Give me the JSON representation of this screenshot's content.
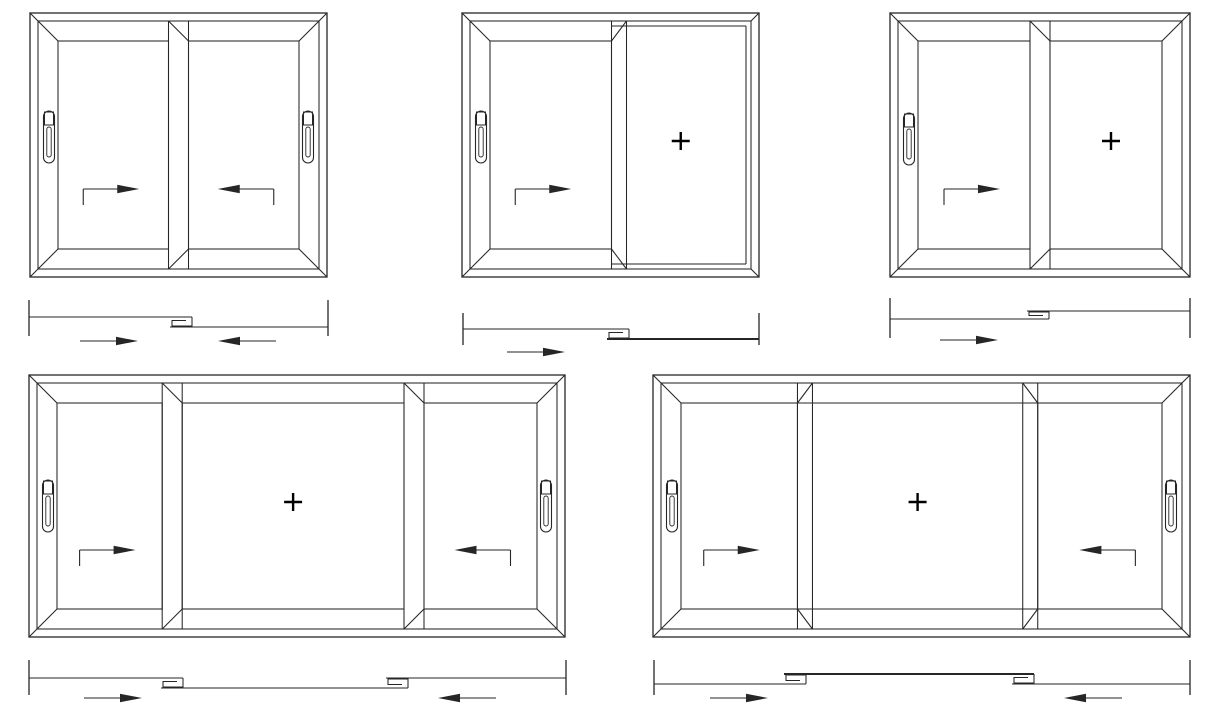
{
  "title": "Sliding window type diagrams",
  "style": {
    "background": "#ffffff",
    "line_color": "#262626",
    "plus_mark_color": "#000000",
    "thin_stroke": 1.05,
    "frame_stroke": 1.3,
    "thick_stroke": 2
  },
  "canvas": {
    "width": 1214,
    "height": 711
  },
  "windows": [
    {
      "id": "window-1",
      "kind": "two-panel-both-sliding",
      "x": 30,
      "y": 13,
      "w": 297,
      "h": 264,
      "handle_dy": -8,
      "panels": [
        {
          "type": "slider",
          "frac": 0.5,
          "handle": "left",
          "arrow": "right"
        },
        {
          "type": "slider",
          "frac": 0.5,
          "handle": "right",
          "arrow": "left"
        }
      ]
    },
    {
      "id": "window-2",
      "kind": "left-sliding-right-fixed",
      "x": 462,
      "y": 13,
      "w": 297,
      "h": 264,
      "handle_dy": -8,
      "panels": [
        {
          "type": "slider",
          "frac": 0.5,
          "handle": "left",
          "arrow": "right"
        },
        {
          "type": "fixed",
          "frac": 0.5,
          "plus": true,
          "glass_inset": 5
        }
      ]
    },
    {
      "id": "window-3",
      "kind": "left-sliding-right-fixed-leaf",
      "x": 890,
      "y": 13,
      "w": 300,
      "h": 264,
      "handle_dy": -6,
      "panels": [
        {
          "type": "slider",
          "frac": 0.5,
          "handle": "left",
          "arrow": "right"
        },
        {
          "type": "slider",
          "frac": 0.5,
          "plus": true
        }
      ]
    },
    {
      "id": "window-4",
      "kind": "three-panel-sliders-fixed-center-leaf",
      "x": 29,
      "y": 375,
      "w": 536,
      "h": 262,
      "handle_dy": 0,
      "panels": [
        {
          "type": "slider",
          "frac": 0.26,
          "handle": "left",
          "arrow": "right"
        },
        {
          "type": "slider",
          "frac": 0.465,
          "plus": true
        },
        {
          "type": "slider",
          "frac": 0.275,
          "handle": "right",
          "arrow": "left"
        }
      ]
    },
    {
      "id": "window-5",
      "kind": "three-panel-sliders-fixed-center-pane",
      "x": 653,
      "y": 375,
      "w": 537,
      "h": 262,
      "handle_dy": 0,
      "panels": [
        {
          "type": "slider",
          "frac": 0.26,
          "handle": "left",
          "arrow": "right"
        },
        {
          "type": "fixed",
          "frac": 0.465,
          "plus": true,
          "glass_inset": 20
        },
        {
          "type": "slider",
          "frac": 0.275,
          "handle": "right",
          "arrow": "left"
        }
      ]
    }
  ],
  "plans": [
    {
      "id": "plan-1",
      "x0": 29,
      "x1": 328,
      "tick_top": 300,
      "tick_bottom": 336,
      "y_upper": 317,
      "y_lower": 327,
      "arrow_y": 341,
      "hooks": [
        {
          "x": 183,
          "type": "A"
        }
      ],
      "arrows": [
        {
          "cx": 106,
          "dir": "right"
        },
        {
          "cx": 250,
          "dir": "left"
        }
      ],
      "thick": []
    },
    {
      "id": "plan-2",
      "x0": 463,
      "x1": 759,
      "tick_top": 313,
      "tick_bottom": 345,
      "y_upper": 329,
      "y_lower": 339,
      "arrow_y": 352,
      "hooks": [
        {
          "x": 620,
          "type": "A"
        }
      ],
      "arrows": [
        {
          "cx": 533,
          "dir": "right"
        }
      ],
      "thick": [
        1
      ]
    },
    {
      "id": "plan-3",
      "x0": 890,
      "x1": 1190,
      "tick_top": 298,
      "tick_bottom": 338,
      "y_upper": 311,
      "y_lower": 319,
      "arrow_y": 340,
      "hooks": [
        {
          "x": 1040,
          "type": "B"
        }
      ],
      "arrows": [
        {
          "cx": 966,
          "dir": "right"
        }
      ],
      "thick": []
    },
    {
      "id": "plan-4",
      "x0": 29,
      "x1": 566,
      "tick_top": 660,
      "tick_bottom": 695,
      "y_upper": 678,
      "y_lower": 688,
      "arrow_y": 698,
      "hooks": [
        {
          "x": 174,
          "type": "A"
        },
        {
          "x": 399,
          "type": "B"
        }
      ],
      "arrows": [
        {
          "cx": 110,
          "dir": "right"
        },
        {
          "cx": 470,
          "dir": "left"
        }
      ],
      "thick": []
    },
    {
      "id": "plan-5",
      "x0": 654,
      "x1": 1190,
      "tick_top": 660,
      "tick_bottom": 695,
      "y_upper": 674,
      "y_lower": 684,
      "arrow_y": 698,
      "hooks": [
        {
          "x": 797,
          "type": "B"
        },
        {
          "x": 1025,
          "type": "A"
        }
      ],
      "arrows": [
        {
          "cx": 736,
          "dir": "right"
        },
        {
          "cx": 1096,
          "dir": "left"
        }
      ],
      "thick": [
        1
      ]
    }
  ]
}
